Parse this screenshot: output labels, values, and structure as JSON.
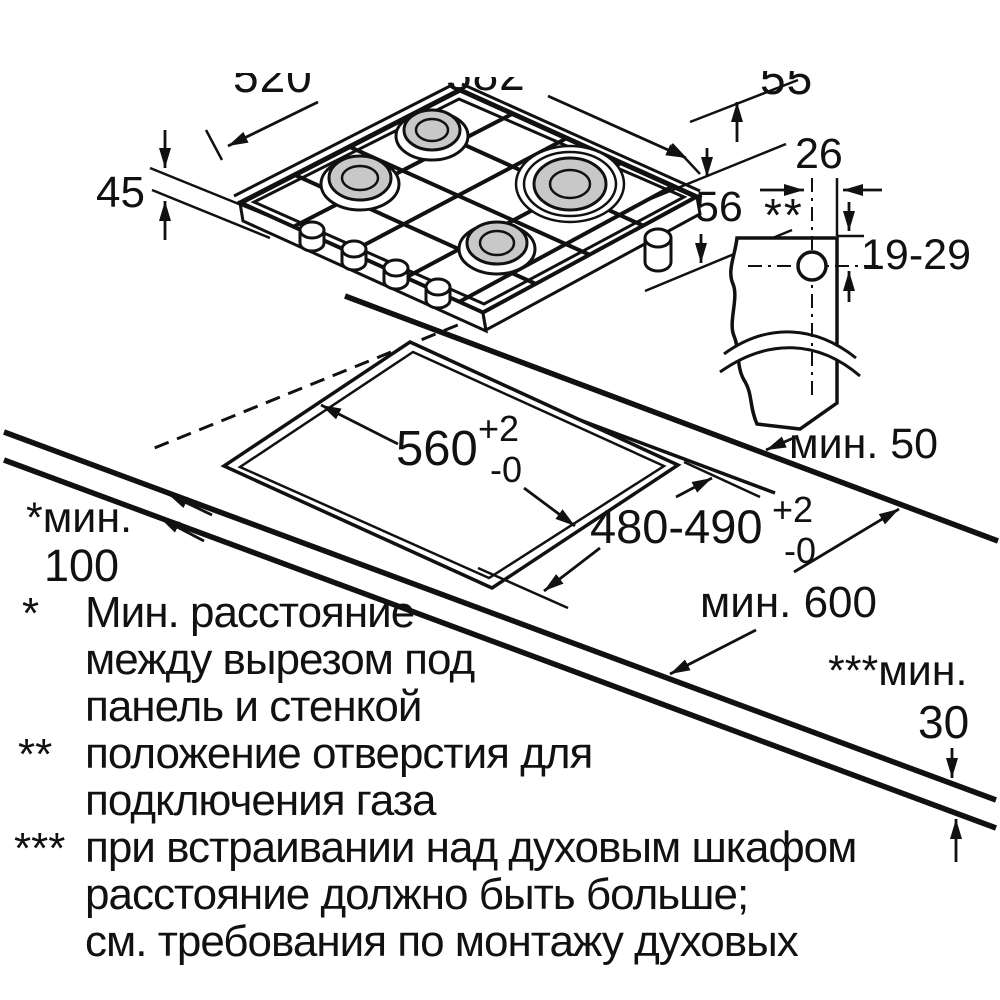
{
  "colors": {
    "line": "#111111",
    "burner_fill": "#c8c8c8",
    "background": "#ffffff"
  },
  "hob": {
    "depth_left": "520",
    "width_top": "582",
    "height_top_right": "55",
    "height_left": "45",
    "height_right": "56"
  },
  "gas_connection": {
    "offset_from_edge": "26",
    "footnote_marker": "**",
    "vertical_range": "19-29"
  },
  "worktop": {
    "rear_clearance": "мин. 50",
    "cutout_width": "560",
    "cutout_width_tol_plus": "+2",
    "cutout_width_tol_minus": "-0",
    "cutout_depth": "480-490",
    "cutout_depth_tol_plus": "+2",
    "cutout_depth_tol_minus": "-0",
    "side_clearance_label": "*мин.",
    "side_clearance_value": "100",
    "min_depth": "мин. 600",
    "thickness_label": "***мин.",
    "thickness_value": "30"
  },
  "footnotes": {
    "f1_marker": "*",
    "f1_line1": "Мин. расстояние",
    "f1_line2": "между вырезом под",
    "f1_line3": "панель и стенкой",
    "f2_marker": "**",
    "f2_line1": "положение отверстия для",
    "f2_line2": "подключения газа",
    "f3_marker": "***",
    "f3_line1": "при встраивании над духовым шкафом",
    "f3_line2": "расстояние должно быть больше;",
    "f3_line3": "см. требования по монтажу духовых"
  }
}
